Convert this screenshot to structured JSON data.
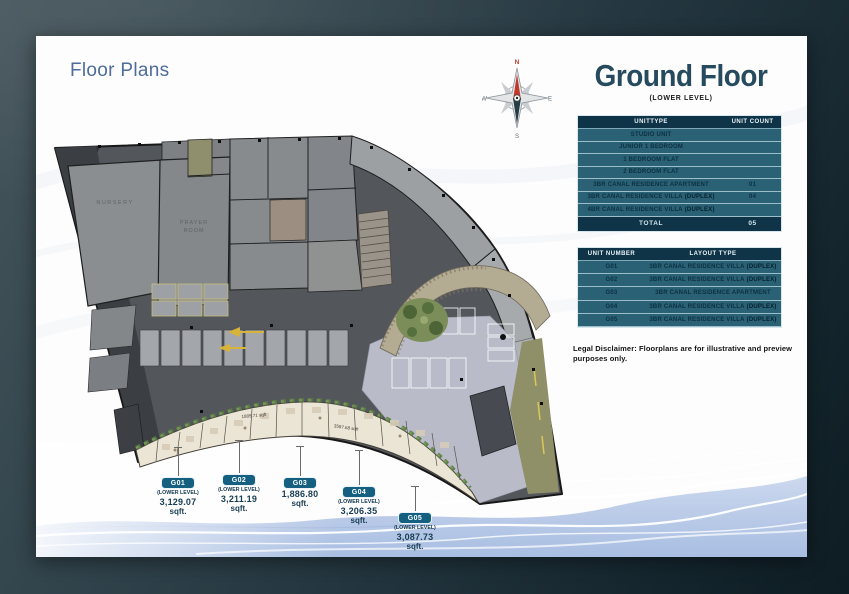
{
  "page": {
    "title": "Floor Plans",
    "heading": "Ground Floor",
    "subheading": "(LOWER LEVEL)"
  },
  "compass": {
    "north": "N",
    "east": "E",
    "south": "S",
    "west": "W"
  },
  "unit_mix_table": {
    "headers": [
      "UNITTYPE",
      "UNIT COUNT"
    ],
    "rows": [
      {
        "type": "STUDIO UNIT",
        "suffix": "",
        "count": ""
      },
      {
        "type": "JUNIOR 1 BEDROOM",
        "suffix": "",
        "count": ""
      },
      {
        "type": "1 BEDROOM FLAT",
        "suffix": "",
        "count": ""
      },
      {
        "type": "2 BEDROOM FLAT",
        "suffix": "",
        "count": ""
      },
      {
        "type": "3BR CANAL RESIDENCE APARTMENT",
        "suffix": "",
        "count": "01"
      },
      {
        "type": "3BR CANAL RESIDENCE VILLA",
        "suffix": "(DUPLEX)",
        "count": "04"
      },
      {
        "type": "4BR CANAL RESIDENCE VILLA",
        "suffix": "(DUPLEX)",
        "count": ""
      }
    ],
    "total_label": "TOTAL",
    "total_value": "05"
  },
  "unit_layout_table": {
    "headers": [
      "UNIT NUMBER",
      "LAYOUT TYPE"
    ],
    "rows": [
      {
        "unit": "G01",
        "layout": "3BR CANAL RESIDENCE VILLA",
        "suffix": "(DUPLEX)"
      },
      {
        "unit": "G02",
        "layout": "3BR CANAL RESIDENCE VILLA",
        "suffix": "(DUPLEX)"
      },
      {
        "unit": "G03",
        "layout": "3BR CANAL RESIDENCE APARTMENT",
        "suffix": ""
      },
      {
        "unit": "G04",
        "layout": "3BR CANAL RESIDENCE VILLA",
        "suffix": "(DUPLEX)"
      },
      {
        "unit": "G05",
        "layout": "3BR CANAL RESIDENCE VILLA",
        "suffix": "(DUPLEX)"
      }
    ]
  },
  "disclaimer": "Legal Disclaimer: Floorplans are for illustrative and preview purposes only.",
  "callouts": [
    {
      "unit": "G01",
      "level": "(LOWER LEVEL)",
      "area": "3,129.07",
      "area_unit": "sqft."
    },
    {
      "unit": "G02",
      "level": "(LOWER LEVEL)",
      "area": "3,211.19",
      "area_unit": "sqft."
    },
    {
      "unit": "G03",
      "level": "",
      "area": "1,886.80",
      "area_unit": "sqft."
    },
    {
      "unit": "G04",
      "level": "(LOWER LEVEL)",
      "area": "3,206.35",
      "area_unit": "sqft."
    },
    {
      "unit": "G05",
      "level": "(LOWER LEVEL)",
      "area": "3,087.73",
      "area_unit": "sqft."
    }
  ],
  "plan": {
    "labels": {
      "nursery": "NURSERY",
      "prayer_line1": "PRAYER",
      "prayer_line2": "ROOM"
    },
    "area_labels": [
      "1885.71 sqft",
      "3597.68 sqft"
    ]
  },
  "colors": {
    "table_header_bg": "#0f3448",
    "table_row_bg": "#2a6174",
    "pill_bg": "#156080",
    "heading_color": "#264b5e",
    "title_color": "#4e6c99",
    "wave_blue": "#aec3e4",
    "compass_red": "#c0392b"
  }
}
